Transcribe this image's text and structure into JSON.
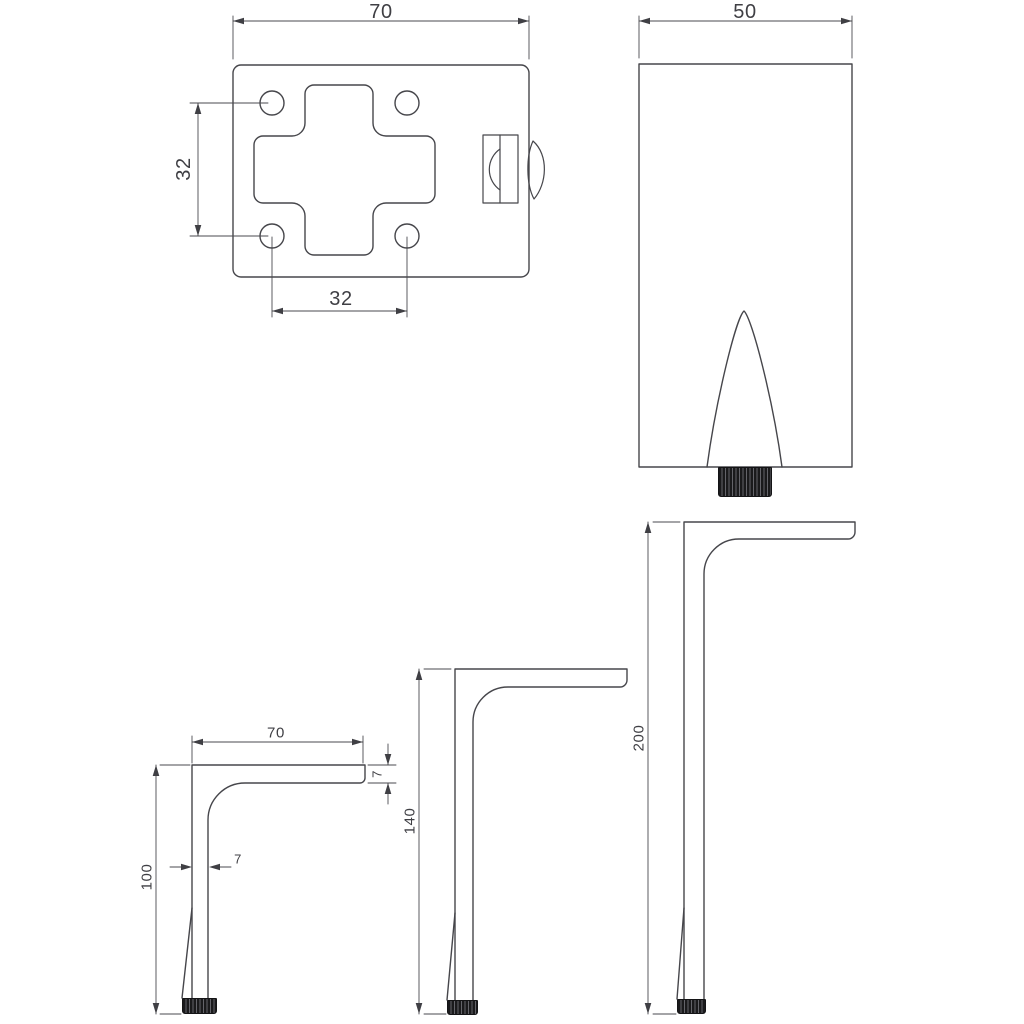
{
  "drawing": {
    "kind": "technical-drawing",
    "colors": {
      "background": "#ffffff",
      "line": "#46464b",
      "dimension": "#3f3f44",
      "foot": "#1a1a1c"
    },
    "plate_view": {
      "width": "70",
      "hole_spacing_vertical": "32",
      "hole_spacing_horizontal": "32"
    },
    "front_view": {
      "width": "50"
    },
    "leg_100": {
      "height": "100",
      "arm_length": "70",
      "arm_thickness": "7",
      "leg_width": "7"
    },
    "leg_140": {
      "height": "140"
    },
    "leg_200": {
      "height": "200"
    }
  }
}
